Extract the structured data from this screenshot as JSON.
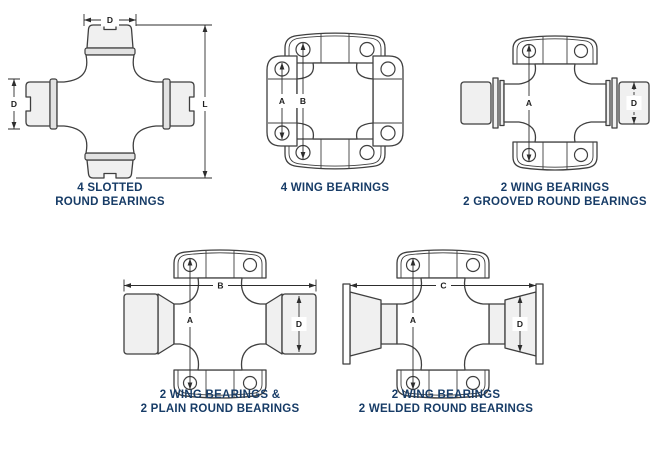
{
  "page": {
    "background": "#ffffff",
    "caption_color": "#173c67",
    "line_color": "#3f3f3f",
    "dim_text_color": "#1d1d1d",
    "bearing_fill": "#f0f0f0"
  },
  "figures": [
    {
      "id": "four-slotted-round",
      "caption_line1": "4 SLOTTED",
      "caption_line2": "ROUND BEARINGS",
      "dims": {
        "top": "D",
        "left": "D",
        "right": "L"
      }
    },
    {
      "id": "four-wing",
      "caption_line1": "4 WING BEARINGS",
      "caption_line2": "",
      "dims": {
        "a": "A",
        "b": "B"
      }
    },
    {
      "id": "two-wing-two-grooved-round",
      "caption_line1": "2 WING BEARINGS",
      "caption_line2": "2 GROOVED ROUND BEARINGS",
      "dims": {
        "a": "A",
        "d": "D"
      }
    },
    {
      "id": "two-wing-two-plain-round",
      "caption_line1": "2 WING BEARINGS &",
      "caption_line2": "2 PLAIN ROUND BEARINGS",
      "dims": {
        "a": "A",
        "b": "B",
        "d": "D"
      }
    },
    {
      "id": "two-wing-two-welded-round",
      "caption_line1": "2 WING BEARINGS",
      "caption_line2": "2 WELDED ROUND BEARINGS",
      "dims": {
        "a": "A",
        "c": "C",
        "d": "D"
      }
    }
  ]
}
